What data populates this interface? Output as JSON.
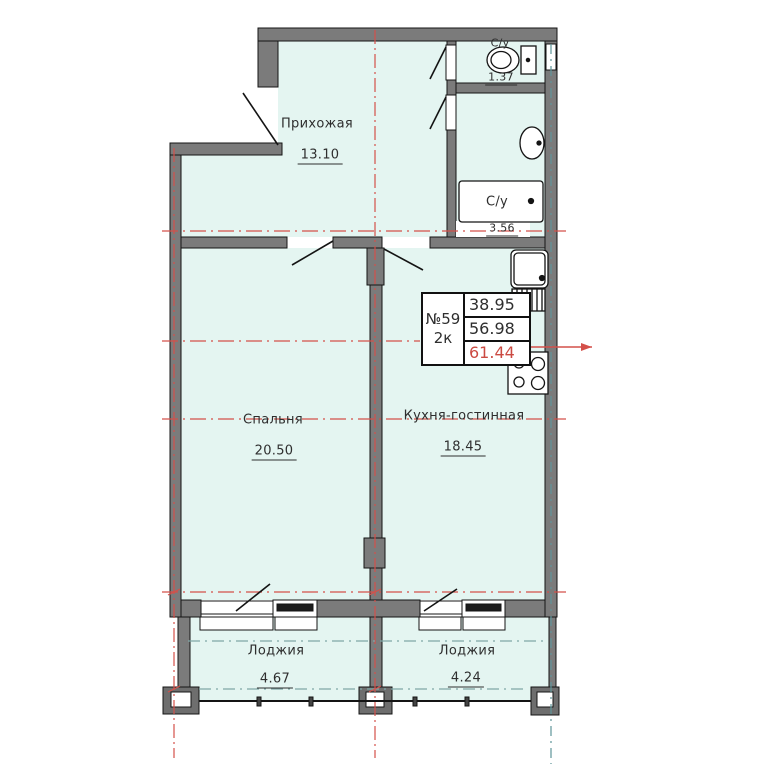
{
  "title": "План квартиры №59 (2к)",
  "unit_info": {
    "number": "№59",
    "type": "2к",
    "area_living": "38.95",
    "area_usable": "56.98",
    "area_total": "61.44"
  },
  "rooms": {
    "hallway": {
      "name": "Прихожая",
      "area": "13.10"
    },
    "bedroom": {
      "name": "Спальня",
      "area": "20.50"
    },
    "kitchen": {
      "name": "Кухня-гостинная",
      "area": "18.45"
    },
    "loggia_left": {
      "name": "Лоджия",
      "area": "4.67"
    },
    "loggia_right": {
      "name": "Лоджия",
      "area": "4.24"
    },
    "wc": {
      "name": "С/у",
      "area": "1.37"
    },
    "bathroom": {
      "name": "С/у",
      "area": "3.56"
    }
  },
  "icons": [
    "toilet-icon",
    "wash-basin-icon",
    "bathtub-icon",
    "kitchen-sink-icon",
    "stove-icon"
  ],
  "colors": {
    "interior_fill": "#e4f5f1",
    "wall_gray": "#7b7b7b",
    "axis_red": "#d4504a",
    "axis_teal": "#5f959a",
    "total_area_red": "#cb4a42",
    "line_black": "#141414"
  }
}
